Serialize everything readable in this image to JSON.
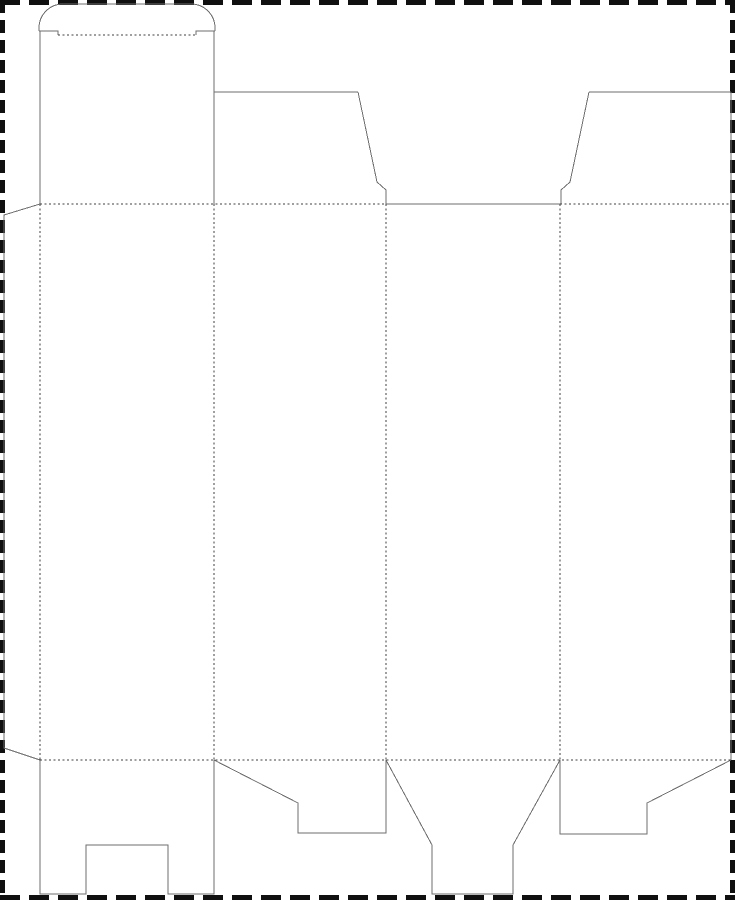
{
  "page": {
    "width": 735,
    "height": 900,
    "background": "#ffffff"
  },
  "border": {
    "color": "#101010",
    "thickness": 5,
    "horizontal_dash": 20,
    "horizontal_gap": 9,
    "vertical_dash": 13,
    "vertical_gap": 7
  },
  "colors": {
    "cut_line": "#6e6e6e",
    "fold_line": "#3f3f3f"
  },
  "dieline": {
    "stroke_width": 1,
    "fold_dash": "2,2.5",
    "paths": [
      {
        "name": "tuck-flap-rounded-top",
        "type": "cut",
        "d": "M 39 31 L 39 28 A 24 24 0 0 1 63 4 L 191 4 A 24 24 0 0 1 215 28 L 215 31"
      },
      {
        "name": "tuck-flap-left-shoulder-cut",
        "type": "cut",
        "d": "M 39 31 L 58 31 L 58 35"
      },
      {
        "name": "tuck-flap-right-shoulder-cut",
        "type": "cut",
        "d": "M 196 35 L 196 31 L 215 31"
      },
      {
        "name": "tuck-panel-left-edge",
        "type": "cut",
        "d": "M 40 31 L 40 204"
      },
      {
        "name": "tuck-panel-right-edge",
        "type": "cut",
        "d": "M 214 31 L 214 204"
      },
      {
        "name": "dust-flap-left-top-edge",
        "type": "cut",
        "d": "M 214 92 L 358 92"
      },
      {
        "name": "dust-flap-left-slant-edge",
        "type": "cut",
        "d": "M 358 92 L 377 182 L 386 190 L 386 204"
      },
      {
        "name": "dust-flap-right-top-edge",
        "type": "cut",
        "d": "M 589 92 L 731 92"
      },
      {
        "name": "dust-flap-right-slant-edge",
        "type": "cut",
        "d": "M 589 92 L 570 182 L 561 190 L 561 204"
      },
      {
        "name": "top-center-cut-edge",
        "type": "cut",
        "d": "M 386 204 L 560 204"
      },
      {
        "name": "right-side-cut-edge",
        "type": "cut",
        "d": "M 731 92 L 731 760"
      },
      {
        "name": "glue-flap-outline",
        "type": "cut",
        "d": "M 40 204 L 4 215 L 4 748 L 40 760"
      },
      {
        "name": "bottom-flap-notched-outline",
        "type": "cut",
        "d": "M 40 760 L 40 894 L 86 894 L 86 845 L 168 845 L 168 894 L 214 894 L 214 760"
      },
      {
        "name": "bottom-flap-left-slant-outline",
        "type": "cut",
        "d": "M 214 760 L 298 803 L 298 833 L 386 833 L 386 760"
      },
      {
        "name": "bottom-tuck-funnel-outline",
        "type": "cut",
        "d": "M 386 760 L 432 845 L 432 894 L 513 894 L 513 845 L 560 760"
      },
      {
        "name": "bottom-flap-right-slant-outline",
        "type": "cut",
        "d": "M 560 760 L 560 834 L 647 834 L 647 803 L 731 760"
      },
      {
        "name": "tuck-flap-fold-line",
        "type": "fold",
        "d": "M 58 35 L 196 35"
      },
      {
        "name": "top-fold-line-left",
        "type": "fold",
        "d": "M 40 204 L 386 204"
      },
      {
        "name": "top-fold-line-right",
        "type": "fold",
        "d": "M 560 204 L 731 204"
      },
      {
        "name": "bottom-fold-line",
        "type": "fold",
        "d": "M 40 760 L 731 760"
      },
      {
        "name": "glue-flap-fold-line",
        "type": "fold",
        "d": "M 40 204 L 40 760"
      },
      {
        "name": "panel-1-2-fold-line",
        "type": "fold",
        "d": "M 214 204 L 214 760"
      },
      {
        "name": "panel-2-3-fold-line",
        "type": "fold",
        "d": "M 386 204 L 386 760"
      },
      {
        "name": "panel-3-4-fold-line",
        "type": "fold",
        "d": "M 560 204 L 560 760"
      }
    ]
  }
}
